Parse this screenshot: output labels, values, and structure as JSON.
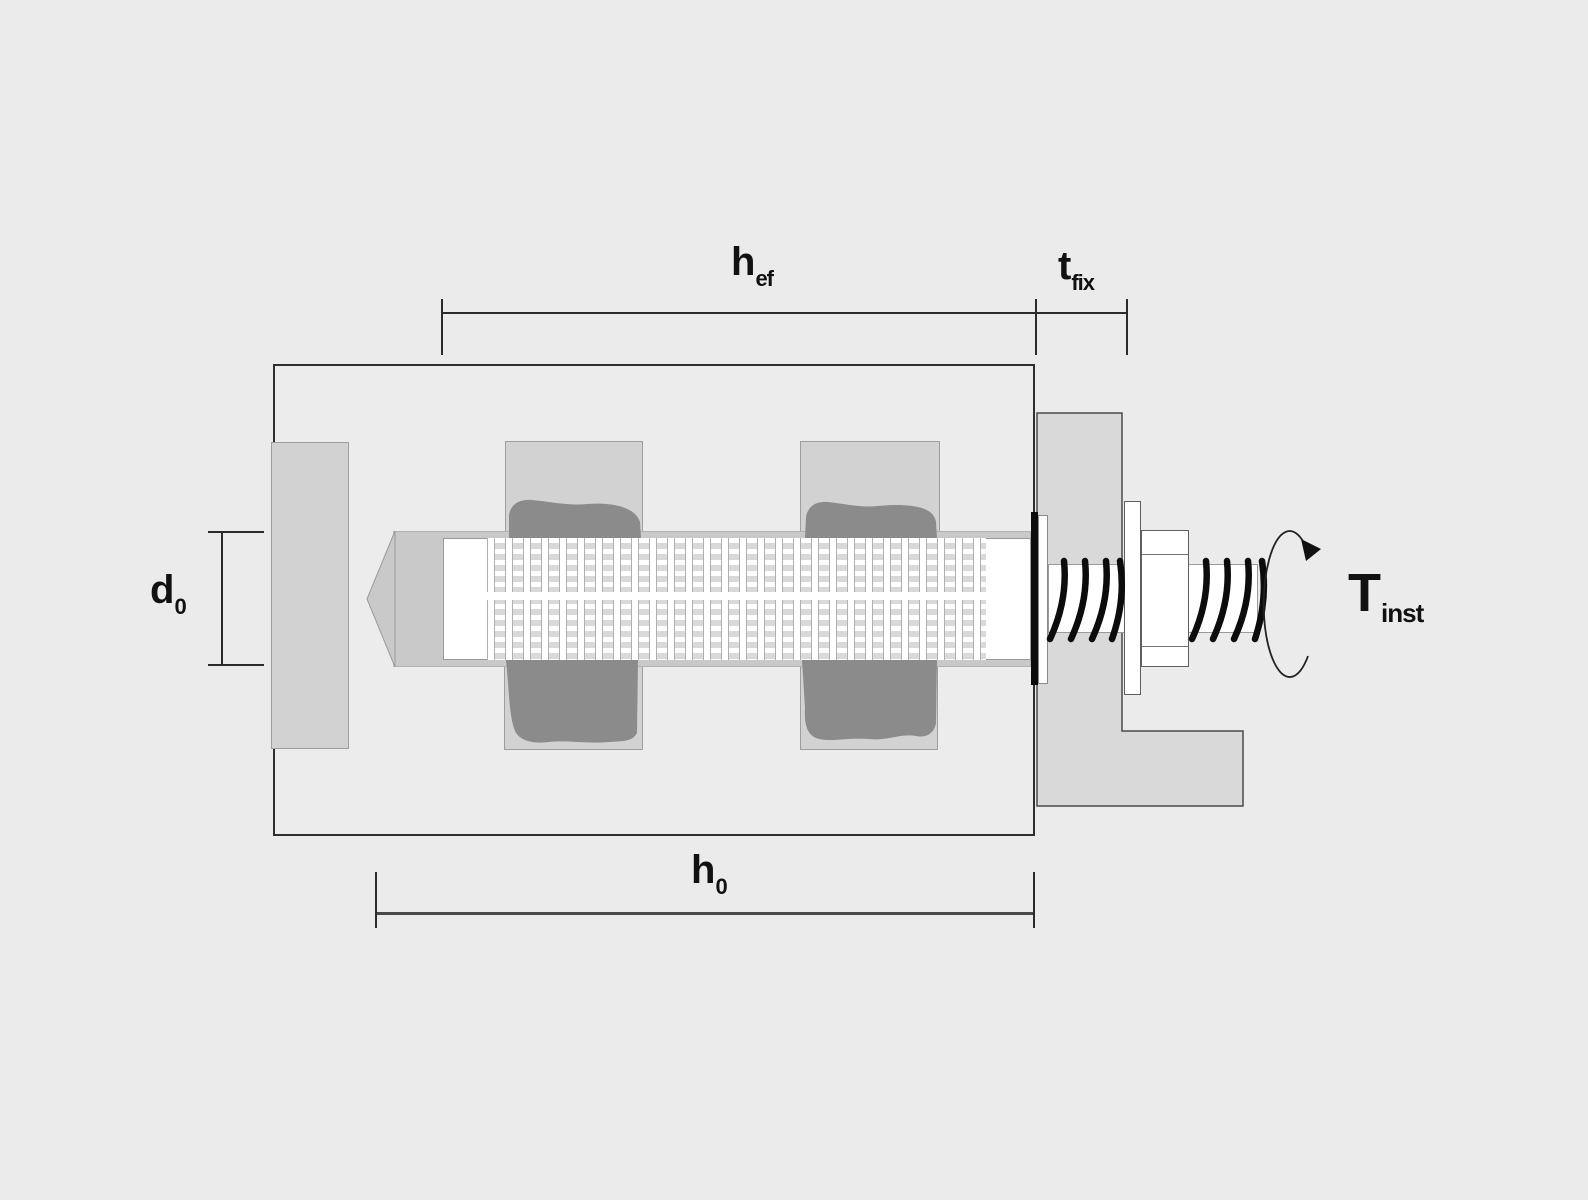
{
  "diagram": {
    "labels": {
      "hef": {
        "main": "h",
        "sub": "ef"
      },
      "tfix": {
        "main": "t",
        "sub": "fix"
      },
      "d0": {
        "main": "d",
        "sub": "0"
      },
      "h0": {
        "main": "h",
        "sub": "0"
      },
      "tinst": {
        "main": "T",
        "sub": "inst"
      }
    },
    "colors": {
      "background": "#ebebeb",
      "base_fill": "#ececec",
      "outline": "#2f2f2f",
      "block_fill": "#d2d2d2",
      "block_border": "#9e9e9e",
      "channel_fill": "#c9c9c9",
      "mortar_fill": "#8b8b8b",
      "fixture_fill": "#d9d9d9",
      "fixture_border": "#4b4b4b",
      "white": "#ffffff",
      "thread_black": "#0c0c0c",
      "dim_line": "#2b2b2b",
      "text": "#111111"
    }
  }
}
